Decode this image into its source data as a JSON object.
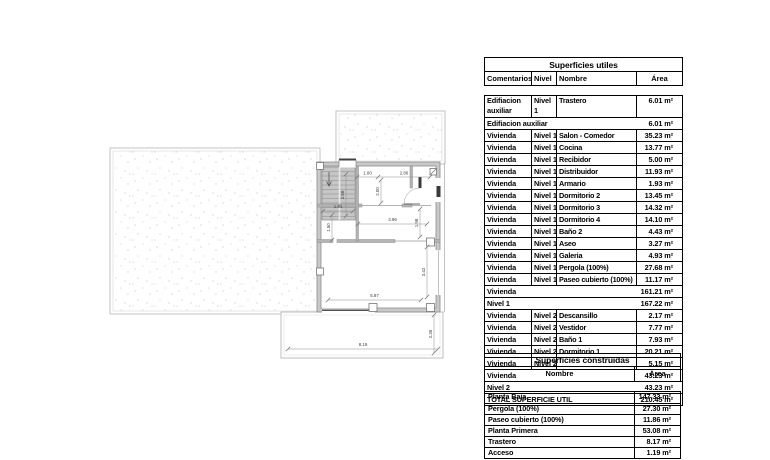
{
  "plan": {
    "dimensions": [
      {
        "name": "dim-1-00",
        "value": "1.00"
      },
      {
        "name": "dim-2-86",
        "value": "2.86"
      },
      {
        "name": "dim-2-00",
        "value": "2.00"
      },
      {
        "name": "dim-2-58",
        "value": "2.58"
      },
      {
        "name": "dim-1-81",
        "value": "1.81"
      },
      {
        "name": "dim-1-50",
        "value": "1.50"
      },
      {
        "name": "dim-3-96",
        "value": "3.96"
      },
      {
        "name": "dim-1-98",
        "value": "1.98"
      },
      {
        "name": "dim-3-42",
        "value": "3.42"
      },
      {
        "name": "dim-5-87",
        "value": "5.87"
      },
      {
        "name": "dim-8-19",
        "value": "8.19"
      },
      {
        "name": "dim-2-35",
        "value": "2.35"
      }
    ],
    "colors": {
      "wall_fill": "#c9c9c9",
      "wall_edge": "#8d8d8d",
      "plot_line": "#bdbdbd",
      "stipple_dot": "#c3c3c3",
      "dim_line": "#8c8c8c",
      "dim_text": "#3c3c3c",
      "dark_detail": "#3a3a3a"
    }
  },
  "superficies_utiles": {
    "title": "Superficies utiles",
    "columns": [
      "Comentarios",
      "Nivel",
      "Nombre",
      "Área"
    ],
    "rows": [
      {
        "type": "data",
        "tall": true,
        "comentarios": "Edifiacion auxiliar",
        "nivel": "Nivel 1",
        "nombre": "Trastero",
        "area": "6.01 m²"
      },
      {
        "type": "subtotal",
        "label": "Edifiacion auxiliar",
        "area": "6.01 m²"
      },
      {
        "type": "data",
        "comentarios": "Vivienda",
        "nivel": "Nivel 1",
        "nombre": "Salon - Comedor",
        "area": "35.23 m²"
      },
      {
        "type": "data",
        "comentarios": "Vivienda",
        "nivel": "Nivel 1",
        "nombre": "Cocina",
        "area": "13.77 m²"
      },
      {
        "type": "data",
        "comentarios": "Vivienda",
        "nivel": "Nivel 1",
        "nombre": "Recibidor",
        "area": "5.00 m²"
      },
      {
        "type": "data",
        "comentarios": "Vivienda",
        "nivel": "Nivel 1",
        "nombre": "Distribuidor",
        "area": "11.93 m²"
      },
      {
        "type": "data",
        "comentarios": "Vivienda",
        "nivel": "Nivel 1",
        "nombre": "Armario",
        "area": "1.93 m²"
      },
      {
        "type": "data",
        "comentarios": "Vivienda",
        "nivel": "Nivel 1",
        "nombre": "Dormitorio 2",
        "area": "13.45 m²"
      },
      {
        "type": "data",
        "comentarios": "Vivienda",
        "nivel": "Nivel 1",
        "nombre": "Dormitorio 3",
        "area": "14.32 m²"
      },
      {
        "type": "data",
        "comentarios": "Vivienda",
        "nivel": "Nivel 1",
        "nombre": "Dormitorio 4",
        "area": "14.10 m²"
      },
      {
        "type": "data",
        "comentarios": "Vivienda",
        "nivel": "Nivel 1",
        "nombre": "Baño 2",
        "area": "4.43 m²"
      },
      {
        "type": "data",
        "comentarios": "Vivienda",
        "nivel": "Nivel 1",
        "nombre": "Aseo",
        "area": "3.27 m²"
      },
      {
        "type": "data",
        "comentarios": "Vivienda",
        "nivel": "Nivel 1",
        "nombre": "Galeria",
        "area": "4.93 m²"
      },
      {
        "type": "data",
        "comentarios": "Vivienda",
        "nivel": "Nivel 1",
        "nombre": "Pergola (100%)",
        "area": "27.68 m²"
      },
      {
        "type": "data",
        "comentarios": "Vivienda",
        "nivel": "Nivel 1",
        "nombre": "Paseo cubierto (100%)",
        "area": "11.17 m²"
      },
      {
        "type": "subtotal",
        "label": "Vivienda",
        "area": "161.21 m²"
      },
      {
        "type": "subtotal",
        "label": "Nivel 1",
        "area": "167.22 m²"
      },
      {
        "type": "data",
        "comentarios": "Vivienda",
        "nivel": "Nivel 2",
        "nombre": "Descansillo",
        "area": "2.17 m²"
      },
      {
        "type": "data",
        "comentarios": "Vivienda",
        "nivel": "Nivel 2",
        "nombre": "Vestidor",
        "area": "7.77 m²"
      },
      {
        "type": "data",
        "comentarios": "Vivienda",
        "nivel": "Nivel 2",
        "nombre": "Baño 1",
        "area": "7.93 m²"
      },
      {
        "type": "data",
        "comentarios": "Vivienda",
        "nivel": "Nivel 2",
        "nombre": "Dormitorio 1",
        "area": "20.21 m²"
      },
      {
        "type": "data",
        "comentarios": "Vivienda",
        "nivel": "Nivel 2",
        "nombre": "",
        "area": "5.15 m²"
      },
      {
        "type": "subtotal",
        "label": "Vivienda",
        "area": "43.23 m²"
      },
      {
        "type": "subtotal",
        "label": "Nivel 2",
        "area": "43.23 m²"
      },
      {
        "type": "total",
        "label": "TOTAL SUPERFICIE UTIL",
        "area": "210.45 m²"
      }
    ]
  },
  "superficies_construidas": {
    "title": "Superficies construidas",
    "columns": [
      "Nombre",
      "Área"
    ],
    "rows": [
      {
        "nombre": "Planta Baja",
        "area": "147.33 m²"
      },
      {
        "nombre": "Pergola (100%)",
        "area": "27.30 m²"
      },
      {
        "nombre": "Paseo cubierto (100%)",
        "area": "11.86 m²"
      },
      {
        "nombre": "Planta Primera",
        "area": "53.08 m²"
      },
      {
        "nombre": "Trastero",
        "area": "8.17 m²"
      },
      {
        "nombre": "Acceso",
        "area": "1.19 m²"
      }
    ]
  }
}
